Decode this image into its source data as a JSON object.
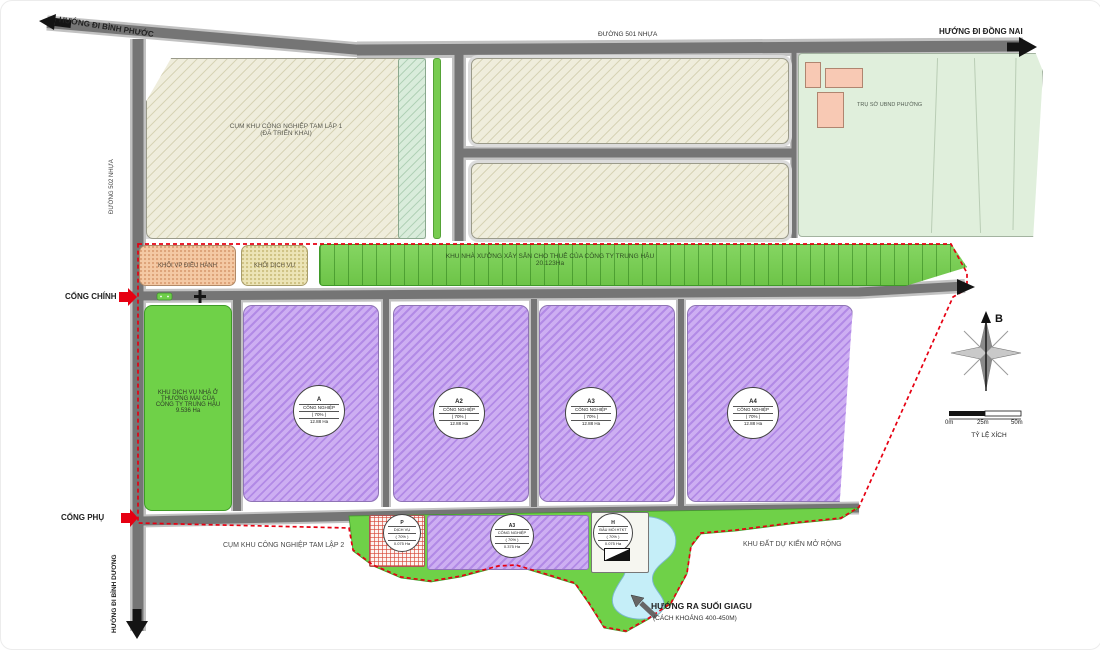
{
  "roads": {
    "binh_phuoc": "HƯỚNG ĐI BÌNH PHƯỚC",
    "duong_501": "ĐƯỜNG 501 NHỰA",
    "dong_nai": "HƯỚNG ĐI ĐỒNG NAI",
    "duong_502": "ĐƯỜNG 502 NHỰA",
    "binh_duong": "HƯỚNG ĐI BÌNH DƯƠNG"
  },
  "gates": {
    "main": "CỔNG CHÍNH",
    "secondary": "CỔNG PHỤ"
  },
  "parcels": {
    "tam_lap_1": {
      "line1": "CỤM KHU CÔNG NGHIỆP TAM LẬP 1",
      "line2": "(ĐÃ TRIỂN KHAI)"
    },
    "ubnd": "TRỤ SỞ UBND PHƯỜNG",
    "khoi_vp": "KHỐI VP ĐIỀU HÀNH",
    "khoi_dich_vu": "KHỐI DỊCH VỤ",
    "workshop": {
      "line1": "KHU NHÀ XƯỞNG XÂY SẴN CHO THUÊ CỦA CÔNG TY TRUNG HẬU",
      "line2": "20.123Ha"
    },
    "khu_dich_vu_nha_o": {
      "line1": "KHU DỊCH VỤ NHÀ Ở",
      "line2": "THƯƠNG MẠI CỦA",
      "line3": "CÔNG TY TRUNG HẬU",
      "line4": "9.536 Ha"
    },
    "tam_lap_2": "CỤM KHU CÔNG NGHIỆP TAM LẬP 2",
    "expansion": "KHU ĐẤT DỰ KIẾN MỞ RỘNG"
  },
  "notes": {
    "suoi_line1": "HƯỚNG RA SUỐI GIAGU",
    "suoi_line2": "(CÁCH KHOẢNG 400-450M)"
  },
  "badges": [
    {
      "code": "A",
      "type": "CÔNG NGHIỆP",
      "density": "( 70% )",
      "area": "12.88 Ha"
    },
    {
      "code": "A2",
      "type": "CÔNG NGHIỆP",
      "density": "( 70% )",
      "area": "12.88 Ha"
    },
    {
      "code": "A3",
      "type": "CÔNG NGHIỆP",
      "density": "( 70% )",
      "area": "12.88 Ha"
    },
    {
      "code": "A4",
      "type": "CÔNG NGHIỆP",
      "density": "( 70% )",
      "area": "12.88 Ha"
    },
    {
      "code": "P",
      "type": "DỊCH VỤ",
      "density": "( 70% )",
      "area": "0.075 Ha"
    },
    {
      "code": "A3",
      "type": "CÔNG NGHIỆP",
      "density": "( 70% )",
      "area": "0.375 Ha"
    },
    {
      "code": "H",
      "type": "ĐẦU MỐI HTKT",
      "density": "( 70% )",
      "area": "0.075 Ha"
    }
  ],
  "compass": {
    "north": "B"
  },
  "scale": {
    "t0": "0m",
    "t1": "25m",
    "t2": "50m",
    "label": "TỶ LỆ XÍCH"
  },
  "colors": {
    "boundary_red": "#E60012",
    "green": "#6FD148",
    "purple": "#CDAEF2",
    "road": "#757575",
    "pond": "#C5EEF8",
    "salmon": "#F4C9A4",
    "beige": "#EFEDDC"
  }
}
